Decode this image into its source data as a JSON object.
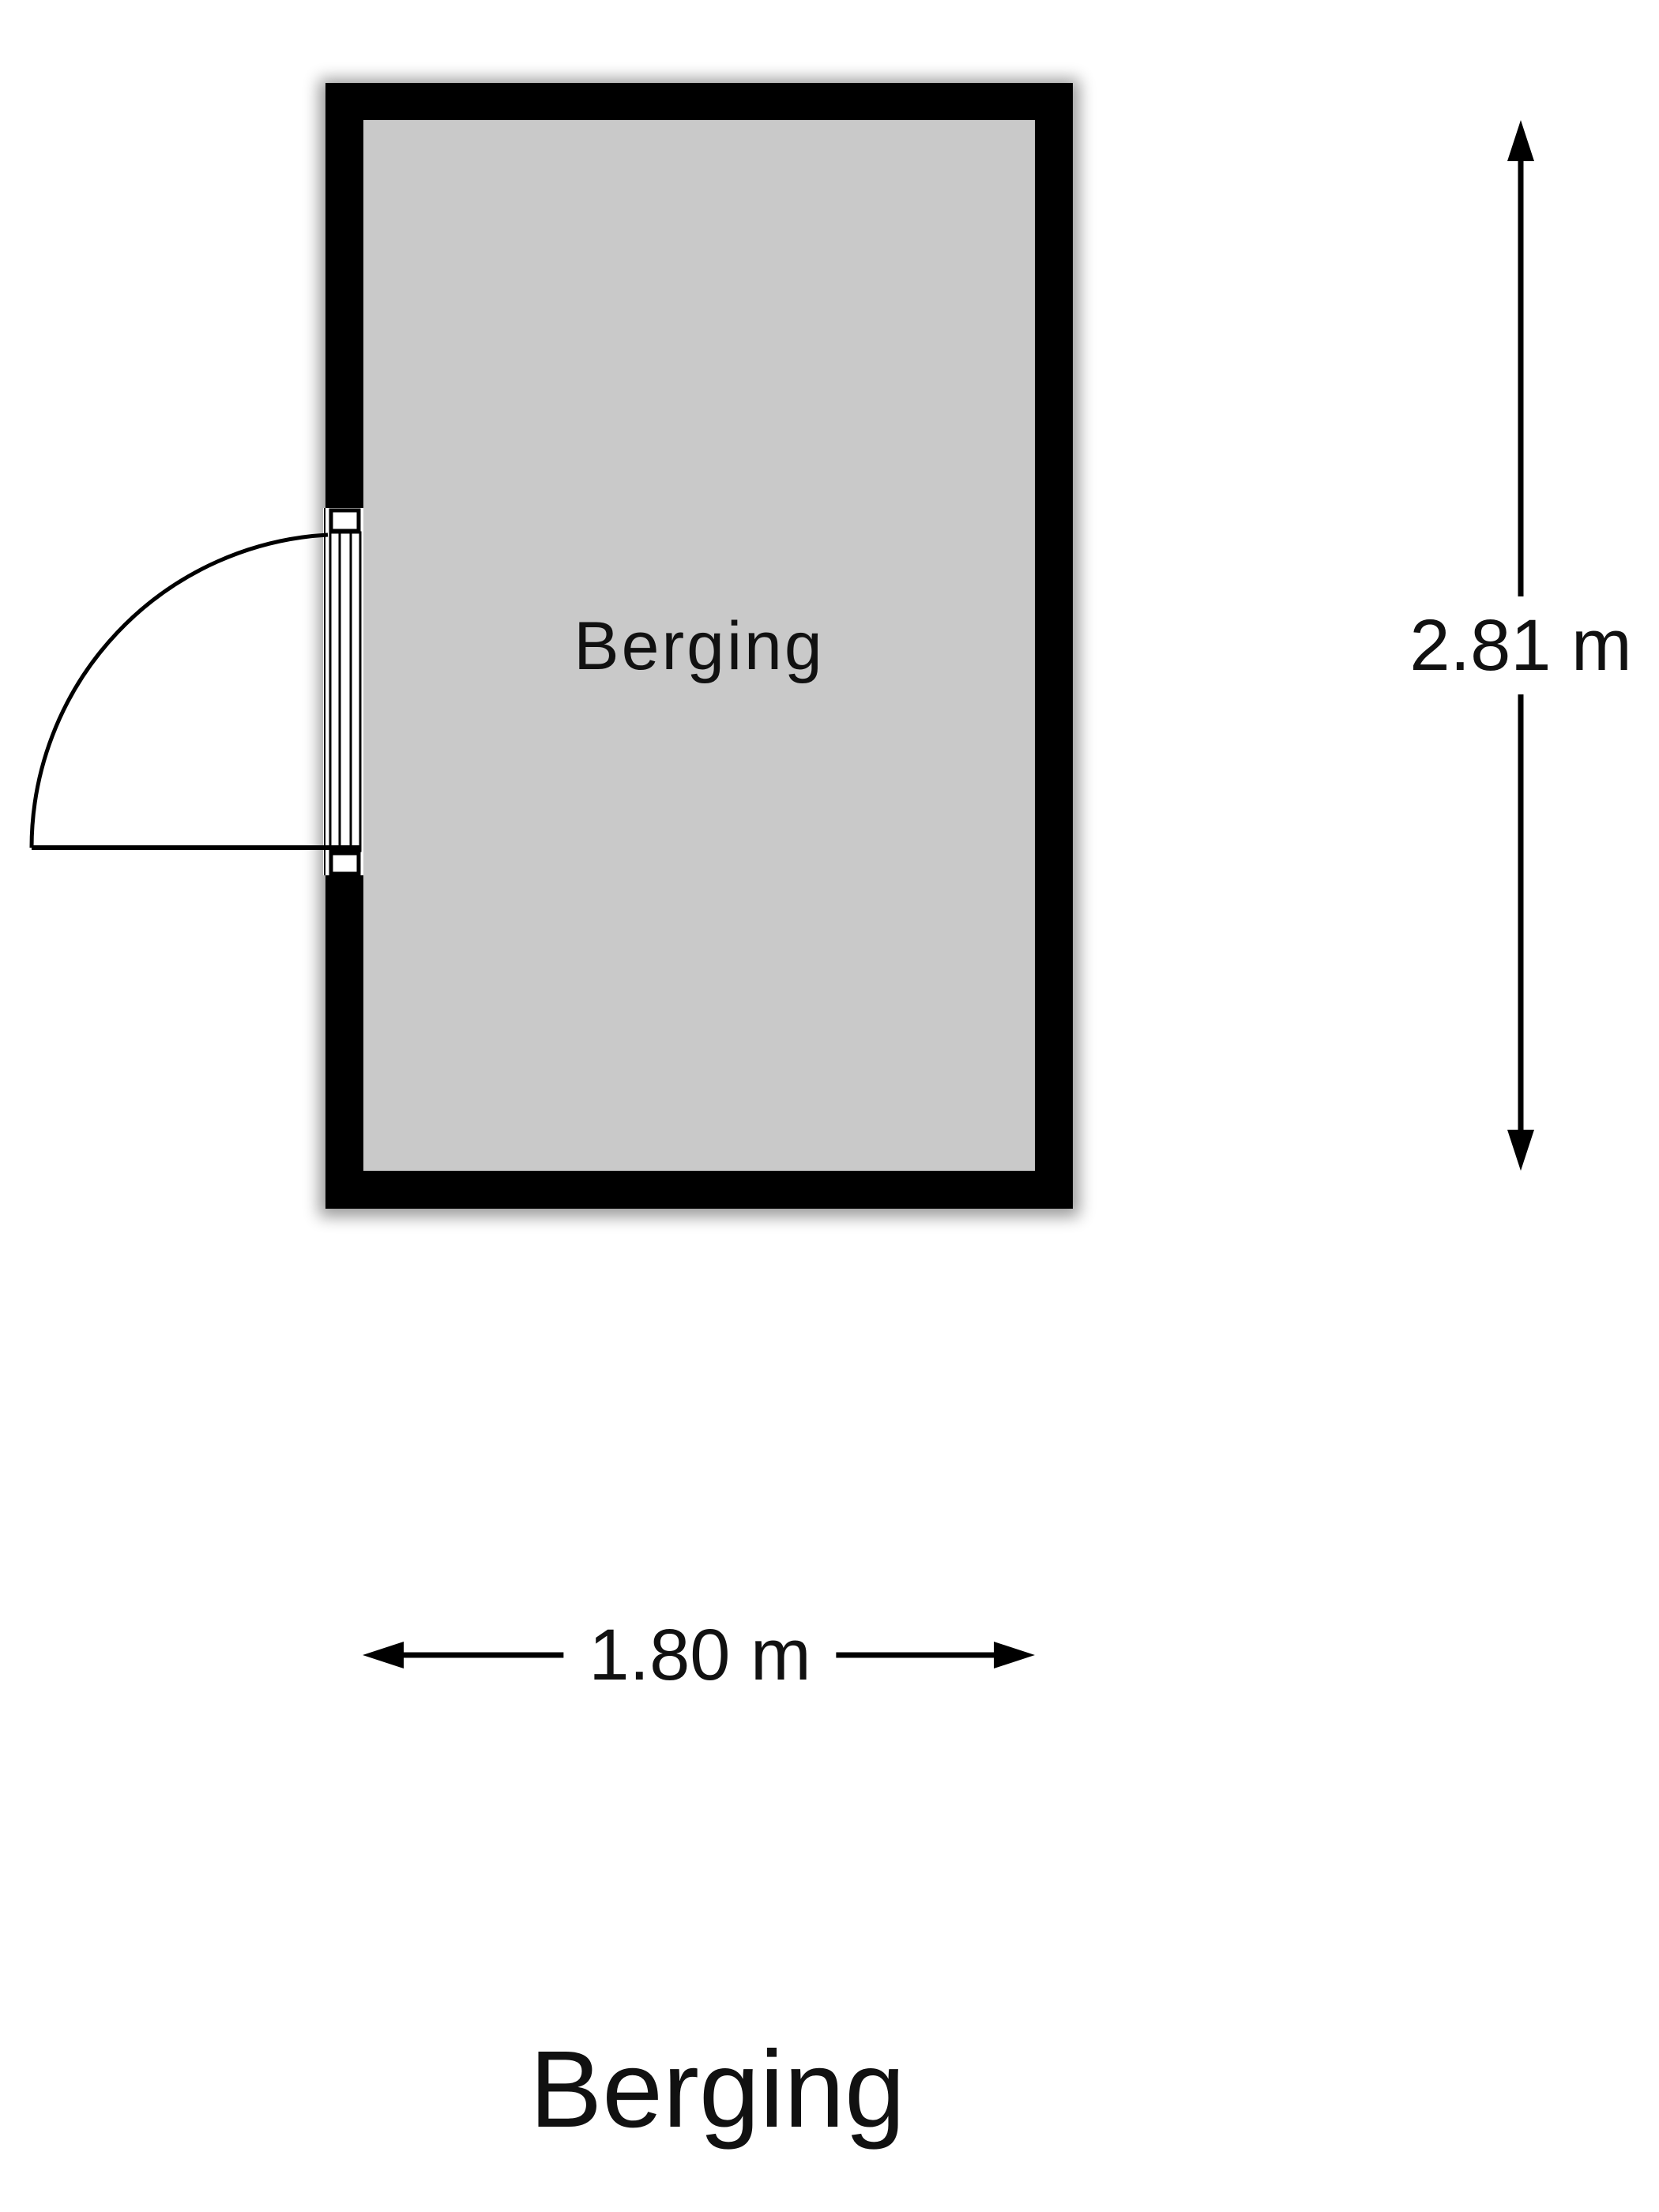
{
  "title": {
    "text": "Berging"
  },
  "room": {
    "label": "Berging"
  },
  "dimensions": {
    "vertical": "2.81 m",
    "horizontal": "1.80 m"
  },
  "colors": {
    "wall": "#000000",
    "floor": "#c9c9c9",
    "line": "#000000",
    "shadow": "#000000",
    "background": "#ffffff",
    "text": "#111111"
  }
}
